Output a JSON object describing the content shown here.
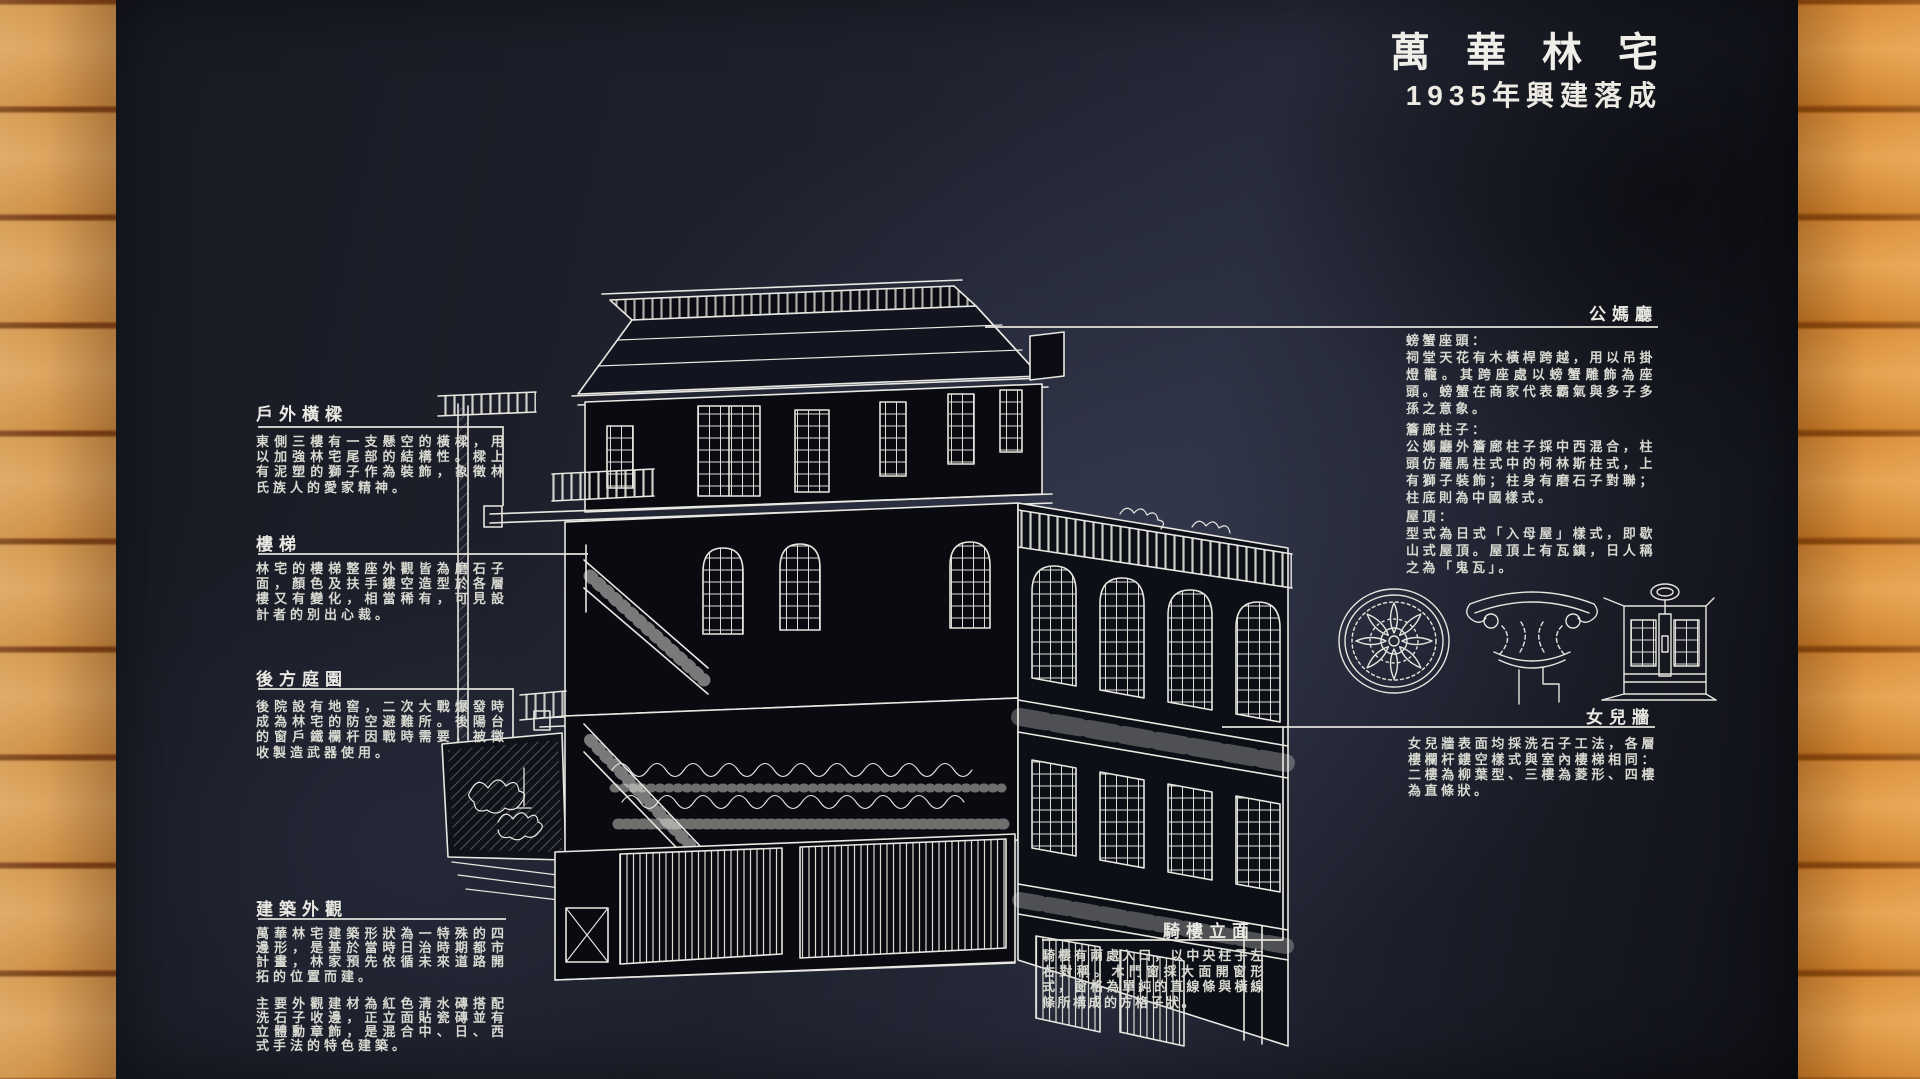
{
  "title": {
    "main": "萬華林宅",
    "subtitle": "1935年興建落成"
  },
  "left_sections": [
    {
      "heading": "戶外橫樑",
      "paragraphs": [
        "東側三樓有一支懸空的橫樑，用以加強林宅尾部的結構性。樑上有泥塑的獅子作為裝飾，象徵林氏族人的愛家精神。"
      ]
    },
    {
      "heading": "樓梯",
      "paragraphs": [
        "林宅的樓梯整座外觀皆為磨石子面，顏色及扶手鏤空造型於各層樓又有變化，相當稀有，可見設計者的別出心裁。"
      ]
    },
    {
      "heading": "後方庭園",
      "paragraphs": [
        "後院設有地窖，二次大戰爆發時成為林宅的防空避難所。後陽台的窗戶鐵欄杆因戰時需要，被徵收製造武器使用。"
      ]
    },
    {
      "heading": "建築外觀",
      "paragraphs": [
        "萬華林宅建築形狀為一特殊的四邊形，是基於當時日治時期都市計畫，林家預先依循未來道路開拓的位置而建。",
        "主要外觀建材為紅色清水磚搭配洗石子收邊，正立面貼瓷磚並有立體勳章飾，是混合中、日、西式手法的特色建築。"
      ]
    }
  ],
  "right_sections": {
    "ancestral_hall": {
      "heading": "公媽廳",
      "items": [
        {
          "label": "螃蟹座頭：",
          "text": "祠堂天花有木橫桿跨越，用以吊掛燈籠。其跨座處以螃蟹雕飾為座頭。螃蟹在商家代表霸氣與多子多孫之意象。"
        },
        {
          "label": "簷廊柱子：",
          "text": "公媽廳外簷廊柱子採中西混合，柱頭仿羅馬柱式中的柯林斯柱式，上有獅子裝飾；柱身有磨石子對聯；柱底則為中國樣式。"
        },
        {
          "label": "屋頂：",
          "text": "型式為日式「入母屋」樣式，即歇山式屋頂。屋頂上有瓦鎮，日人稱之為「鬼瓦」。"
        }
      ]
    },
    "parapet": {
      "heading": "女兒牆",
      "text": "女兒牆表面均採洗石子工法，各層樓欄杆鏤空樣式與室內樓梯相同：二樓為柳葉型、三樓為菱形、四樓為直條狀。"
    },
    "arcade": {
      "heading": "騎樓立面",
      "text": "騎樓有兩處入口，以中央柱子左右對稱。木門窗採大面開窗形式，窗格為單純的直線條與橫線條所構成的方格子狀。"
    }
  },
  "illustrations": [
    {
      "name": "ceiling-medallion-drawing"
    },
    {
      "name": "column-capital-drawing"
    },
    {
      "name": "window-elevation-drawing"
    }
  ],
  "colors": {
    "board": "#1f222e",
    "line_art": "#e8e7e1",
    "text": "#d8d9d1",
    "wood_left": "#d79c52",
    "wood_right": "#dc9340"
  }
}
